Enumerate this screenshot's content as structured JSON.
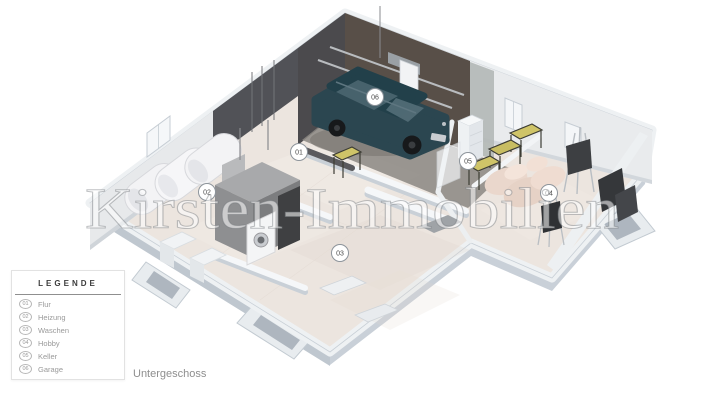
{
  "watermark": {
    "text": "Kirsten-Immobilien"
  },
  "caption": {
    "text": "Untergeschoss"
  },
  "legend": {
    "title": "LEGENDE",
    "items": [
      {
        "number": "01",
        "label": "Flur"
      },
      {
        "number": "02",
        "label": "Heizung"
      },
      {
        "number": "03",
        "label": "Waschen"
      },
      {
        "number": "04",
        "label": "Hobby"
      },
      {
        "number": "05",
        "label": "Keller"
      },
      {
        "number": "06",
        "label": "Garage"
      }
    ]
  },
  "floorplan": {
    "view": "3d-isometric-cutaway-basement",
    "level_label": "Untergeschoss",
    "badges": [
      {
        "number": "01",
        "room": "Flur",
        "x": 299,
        "y": 152
      },
      {
        "number": "02",
        "room": "Heizung",
        "x": 207,
        "y": 192
      },
      {
        "number": "03",
        "room": "Waschen",
        "x": 340,
        "y": 253
      },
      {
        "number": "04",
        "room": "Hobby",
        "x": 549,
        "y": 193
      },
      {
        "number": "05",
        "room": "Keller",
        "x": 468,
        "y": 161
      },
      {
        "number": "06",
        "room": "Garage",
        "x": 375,
        "y": 97
      }
    ],
    "colors": {
      "floor": "#ece5df",
      "slab_side": "#c9d0d8",
      "wall_light": "#e7e9eb",
      "wall_dark_gray": "#515257",
      "garage_wall_brown": "#584f48",
      "car_teal": "#2b4650",
      "bench_top_khaki": "#cfc468",
      "sofa_beige": "#ead7cc"
    }
  }
}
